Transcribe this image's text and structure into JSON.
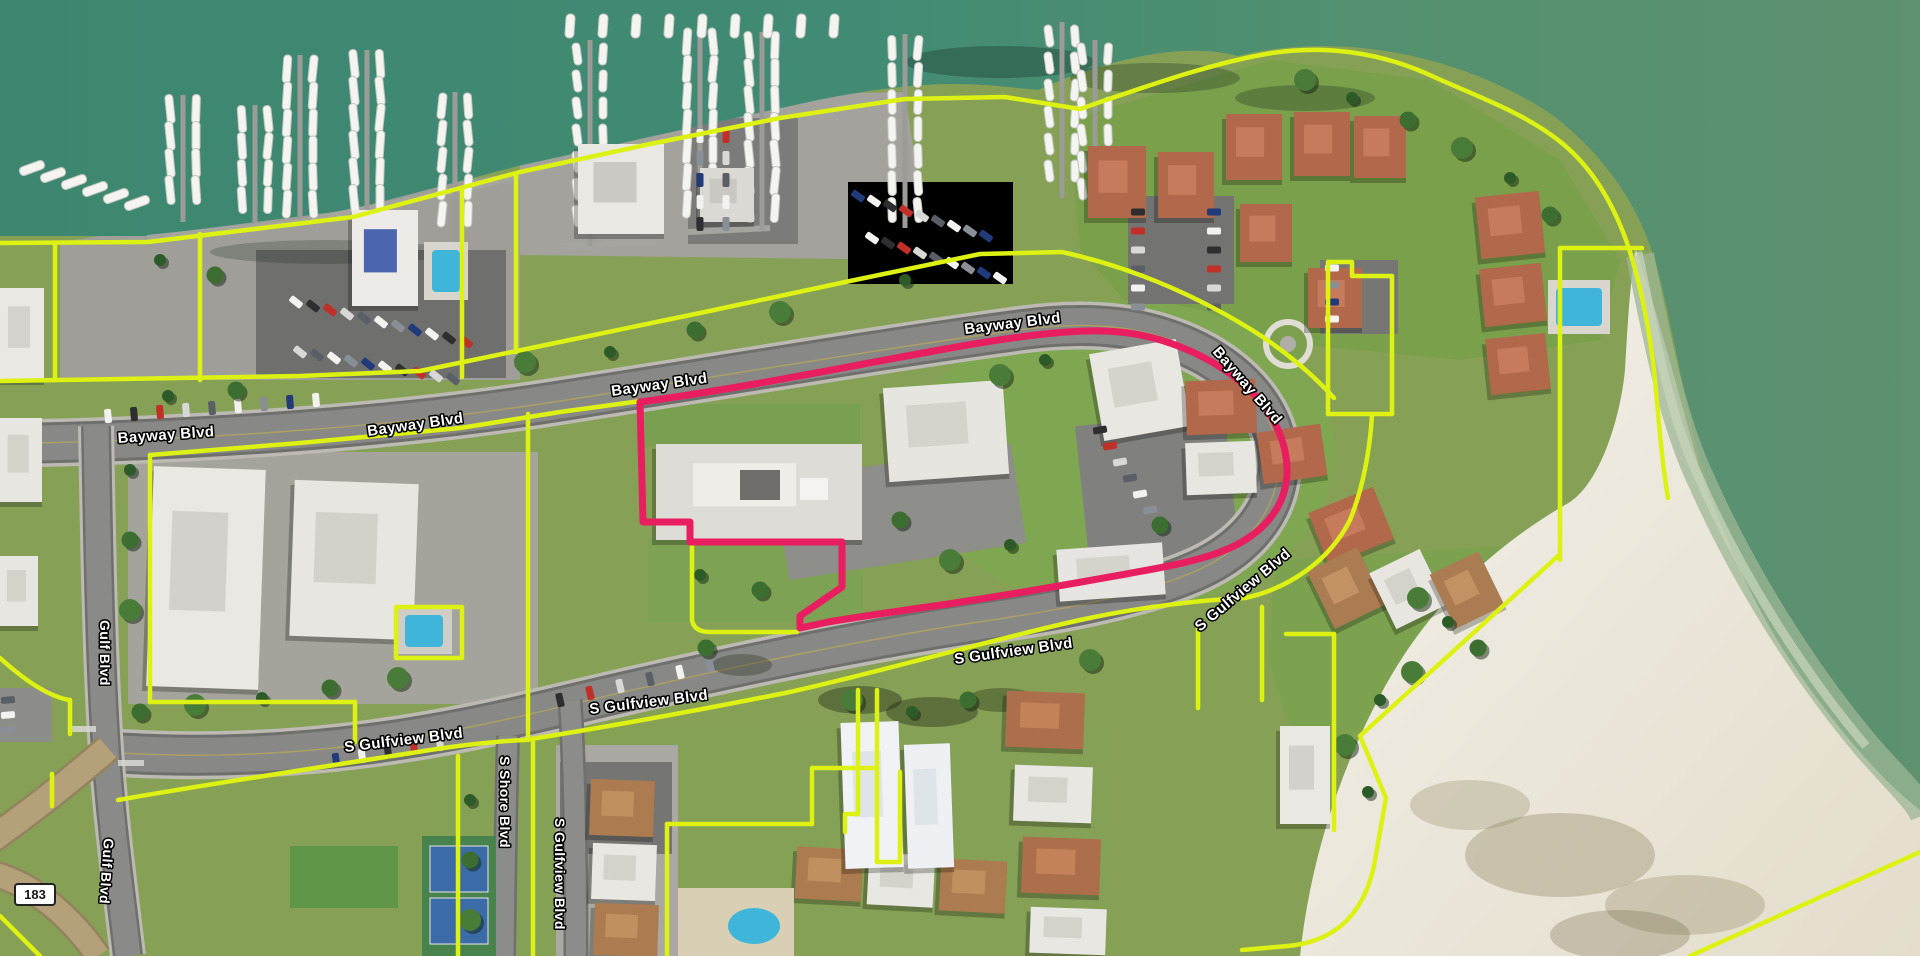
{
  "map": {
    "street_labels": [
      {
        "text": "Bayway Blvd",
        "x": 118,
        "y": 443,
        "rot": -4,
        "size": 15
      },
      {
        "text": "Bayway Blvd",
        "x": 368,
        "y": 436,
        "rot": -8,
        "size": 15
      },
      {
        "text": "Bayway Blvd",
        "x": 612,
        "y": 396,
        "rot": -8,
        "size": 15
      },
      {
        "text": "Bayway Blvd",
        "x": 965,
        "y": 334,
        "rot": -7,
        "size": 15
      },
      {
        "text": "Bayway Blvd",
        "x": 1212,
        "y": 352,
        "rot": 49,
        "size": 15
      },
      {
        "text": "S Gulfview Blvd",
        "x": 345,
        "y": 752,
        "rot": -7,
        "size": 15
      },
      {
        "text": "S Gulfview Blvd",
        "x": 590,
        "y": 714,
        "rot": -7,
        "size": 15
      },
      {
        "text": "S Gulfview Blvd",
        "x": 955,
        "y": 664,
        "rot": -8,
        "size": 15
      },
      {
        "text": "S Gulfview Blvd",
        "x": 1200,
        "y": 632,
        "rot": -40,
        "size": 15
      },
      {
        "text": "Gulf Blvd",
        "x": 100,
        "y": 620,
        "rot": 90,
        "size": 14
      },
      {
        "text": "Gulf Blvd",
        "x": 104,
        "y": 838,
        "rot": 94,
        "size": 14
      },
      {
        "text": "S Shore Blvd",
        "x": 500,
        "y": 756,
        "rot": 90,
        "size": 14
      },
      {
        "text": "S Gulfview Blvd",
        "x": 555,
        "y": 818,
        "rot": 90,
        "size": 14
      }
    ],
    "route_shield": {
      "number": "183"
    },
    "overlay_colors": {
      "parcel_boundary": "#ddf213",
      "selected_parcel": "#e81e60"
    }
  }
}
